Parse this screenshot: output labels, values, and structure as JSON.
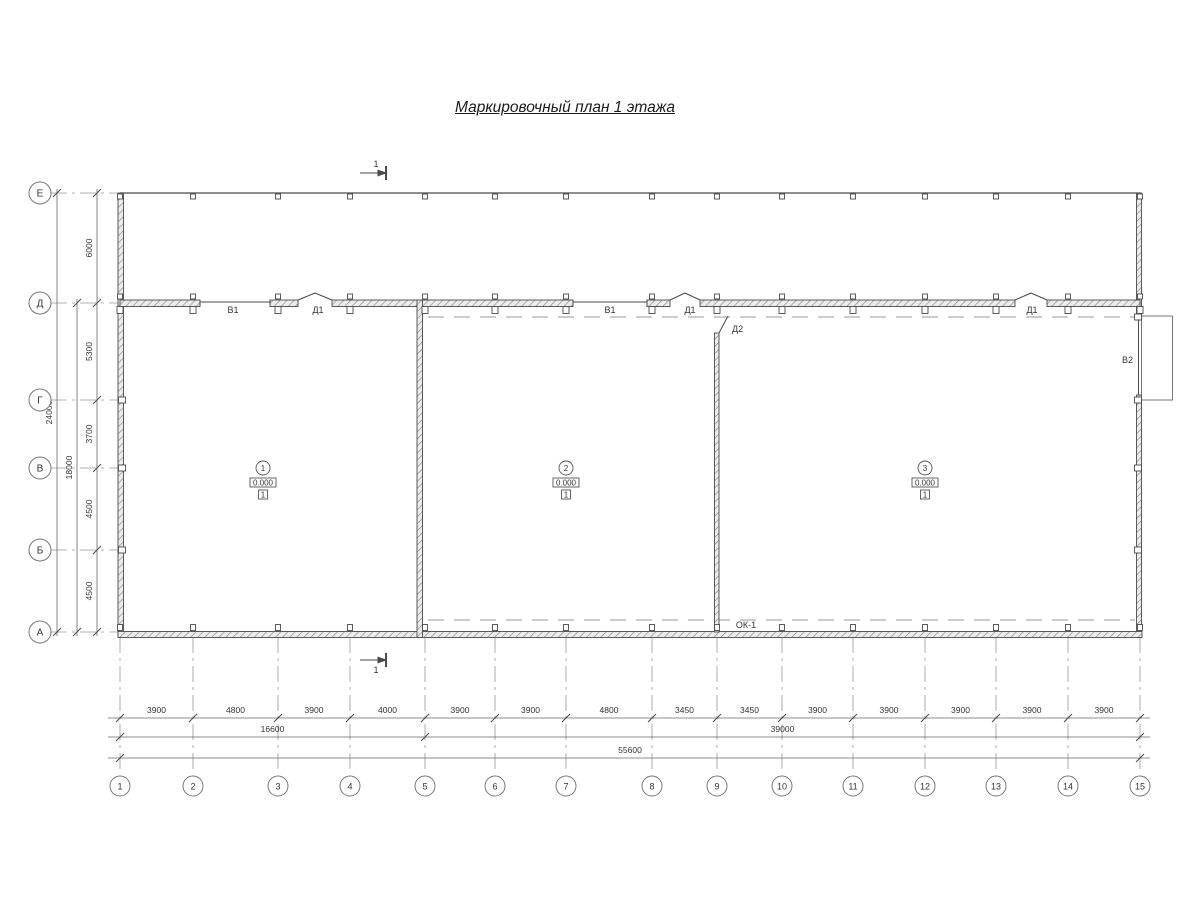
{
  "title": "Маркировочный план 1 этажа",
  "colors": {
    "line": "#4a4a4a",
    "thin_line": "#666666",
    "dashed": "#999999",
    "text": "#333333",
    "wall_fill": "#ececec",
    "hatch": "#8f8f8f"
  },
  "plan": {
    "vertical_axes": [
      {
        "label": "Е",
        "y": 193
      },
      {
        "label": "Д",
        "y": 303
      },
      {
        "label": "Г",
        "y": 400
      },
      {
        "label": "В",
        "y": 468
      },
      {
        "label": "Б",
        "y": 550
      },
      {
        "label": "А",
        "y": 632
      }
    ],
    "horizontal_axes": [
      {
        "label": "1",
        "x": 120
      },
      {
        "label": "2",
        "x": 193
      },
      {
        "label": "3",
        "x": 278
      },
      {
        "label": "4",
        "x": 350
      },
      {
        "label": "5",
        "x": 425
      },
      {
        "label": "6",
        "x": 495
      },
      {
        "label": "7",
        "x": 566
      },
      {
        "label": "8",
        "x": 652
      },
      {
        "label": "9",
        "x": 717
      },
      {
        "label": "10",
        "x": 782
      },
      {
        "label": "11",
        "x": 853
      },
      {
        "label": "12",
        "x": 925
      },
      {
        "label": "13",
        "x": 996
      },
      {
        "label": "14",
        "x": 1068
      },
      {
        "label": "15",
        "x": 1140
      }
    ],
    "left_dimensions": {
      "segments": [
        {
          "value": "6000",
          "from": "Е",
          "to": "Д"
        },
        {
          "value": "5300",
          "from": "Д",
          "to": "Г"
        },
        {
          "value": "3700",
          "from": "Г",
          "to": "В"
        },
        {
          "value": "4500",
          "from": "В",
          "to": "Б"
        },
        {
          "value": "4500",
          "from": "Б",
          "to": "А"
        }
      ],
      "subtotal": {
        "value": "18000",
        "from": "Д",
        "to": "А"
      },
      "total": {
        "value": "24000",
        "from": "Е",
        "to": "А"
      }
    },
    "bottom_dimensions": {
      "segments": [
        "3900",
        "4800",
        "3900",
        "4000",
        "3900",
        "3900",
        "4800",
        "3450",
        "3450",
        "3900",
        "3900",
        "3900",
        "3900",
        "3900"
      ],
      "subtotals": [
        {
          "value": "16600",
          "from": "1",
          "to": "5"
        },
        {
          "value": "39000",
          "from": "5",
          "to": "15"
        }
      ],
      "total": {
        "value": "55600",
        "from": "1",
        "to": "15"
      }
    },
    "opening_labels": [
      {
        "label": "В1",
        "x": 233,
        "y": 313,
        "anchor": "middle"
      },
      {
        "label": "Д1",
        "x": 318,
        "y": 313,
        "anchor": "middle"
      },
      {
        "label": "В1",
        "x": 610,
        "y": 313,
        "anchor": "middle"
      },
      {
        "label": "Д1",
        "x": 690,
        "y": 313,
        "anchor": "middle"
      },
      {
        "label": "Д2",
        "x": 732,
        "y": 332,
        "anchor": "start"
      },
      {
        "label": "Д1",
        "x": 1032,
        "y": 313,
        "anchor": "middle"
      },
      {
        "label": "В2",
        "x": 1133,
        "y": 363,
        "anchor": "end"
      },
      {
        "label": "ОК-1",
        "x": 746,
        "y": 628,
        "anchor": "middle"
      }
    ],
    "rooms": [
      {
        "number": "1",
        "elevation": "0.000",
        "floor_type": "1",
        "x": 263,
        "y": 468
      },
      {
        "number": "2",
        "elevation": "0.000",
        "floor_type": "1",
        "x": 566,
        "y": 468
      },
      {
        "number": "3",
        "elevation": "0.000",
        "floor_type": "1",
        "x": 925,
        "y": 468
      }
    ],
    "section_marks": [
      {
        "label": "1",
        "x": 374,
        "y": 173,
        "text_above": true
      },
      {
        "label": "1",
        "x": 374,
        "y": 660,
        "text_above": false
      }
    ]
  }
}
